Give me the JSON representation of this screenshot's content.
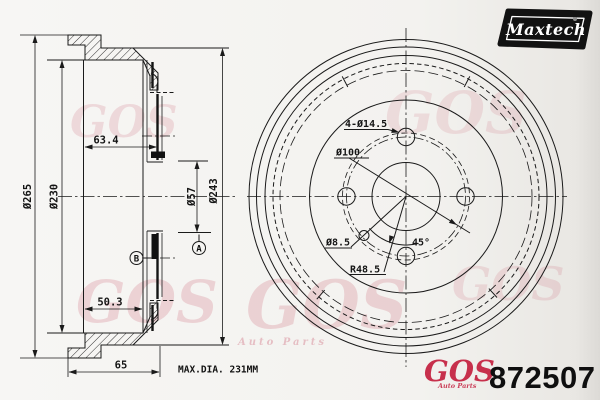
{
  "brand_logo": {
    "text": "Maxtech"
  },
  "watermark": {
    "text": "GOS",
    "caption": "Auto Parts"
  },
  "footer": {
    "vendor_logo": "GOS",
    "vendor_caption": "Auto Parts",
    "part_number": "872507"
  },
  "notes": {
    "max_dia": "MAX.DIA. 231MM"
  },
  "section_view": {
    "outer_diameter": "Ø265",
    "drum_inner_diameter": "Ø230",
    "hub_depth": "63.4",
    "bore_diameter": "Ø57",
    "flange_diameter": "Ø243",
    "inner_depth": "50.3",
    "overall_depth": "65",
    "datum_a": "A",
    "datum_b": "B"
  },
  "front_view": {
    "bolt_holes": "4-Ø14.5",
    "bolt_circle_diameter": "Ø100",
    "small_hole_diameter": "Ø8.5",
    "hole_angle": "45°",
    "hole_radius": "R48.5"
  }
}
